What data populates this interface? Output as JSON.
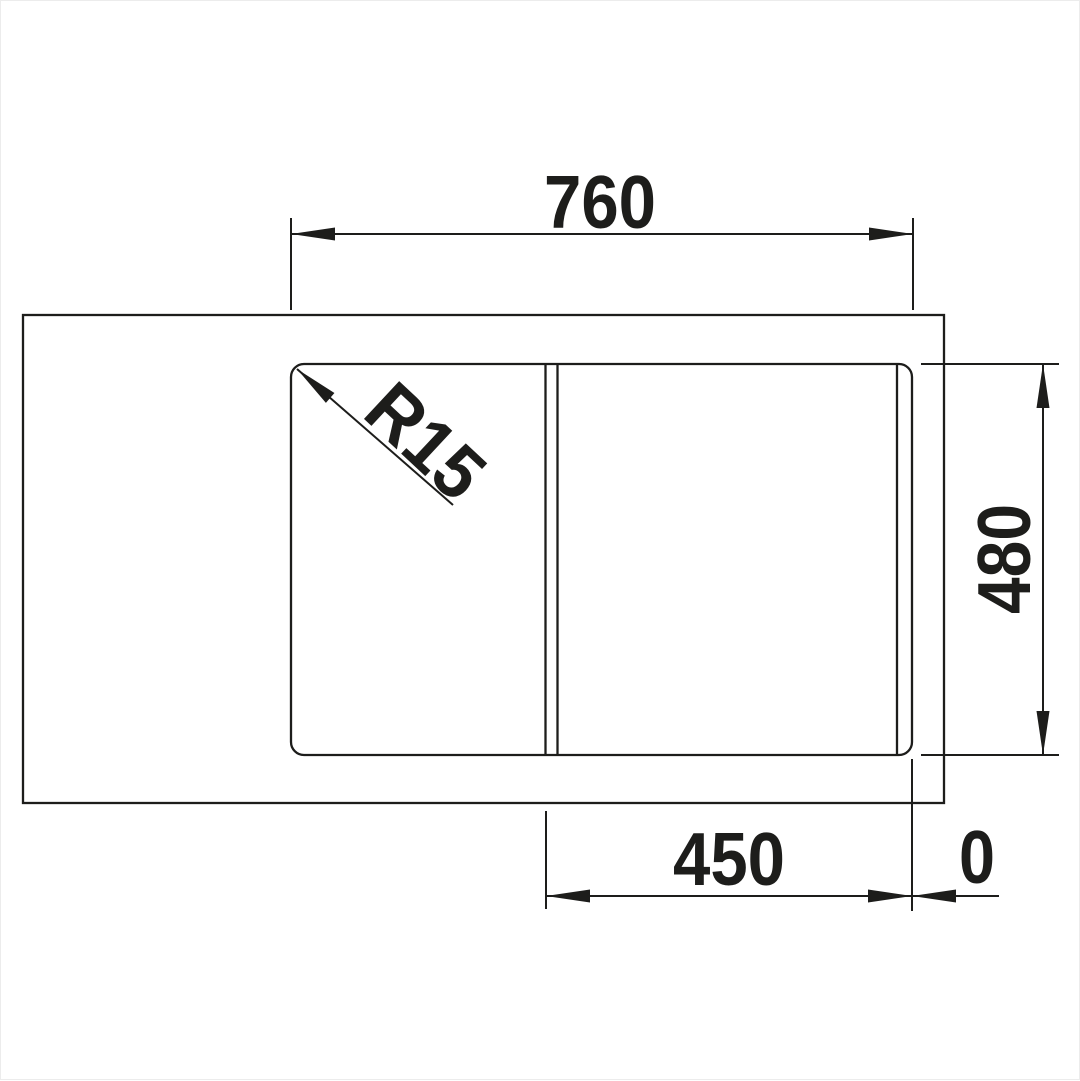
{
  "drawing": {
    "type": "sink-installation-dimension-drawing",
    "labels": {
      "top_width": "760",
      "right_height": "480",
      "bottom_bowl_width": "450",
      "bottom_right_offset": "0",
      "corner_radius": "R15"
    }
  },
  "colors": {
    "line": "#1d1d1b",
    "background": "#ffffff"
  }
}
